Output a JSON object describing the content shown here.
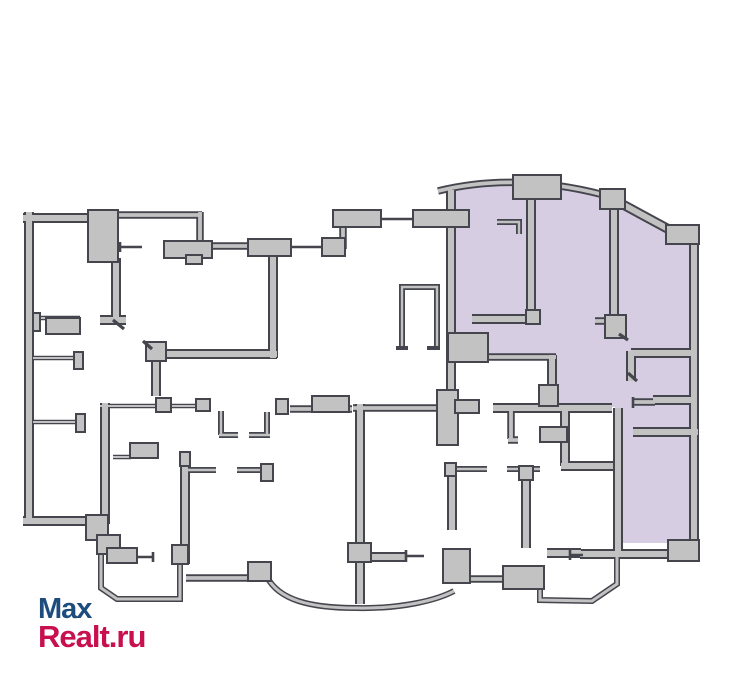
{
  "watermark": {
    "line1": "Max",
    "line2": "Realt.ru",
    "line1_color": "#1d4c7d",
    "line2_color": "#c8104e"
  },
  "plan": {
    "background": "#ffffff",
    "wall_fill": "#c2c2c2",
    "wall_outline": "#45454e",
    "highlight_fill": "#d6cde2",
    "highlight_meaning": "highlighted apartment unit",
    "line_color": "#45454e"
  }
}
